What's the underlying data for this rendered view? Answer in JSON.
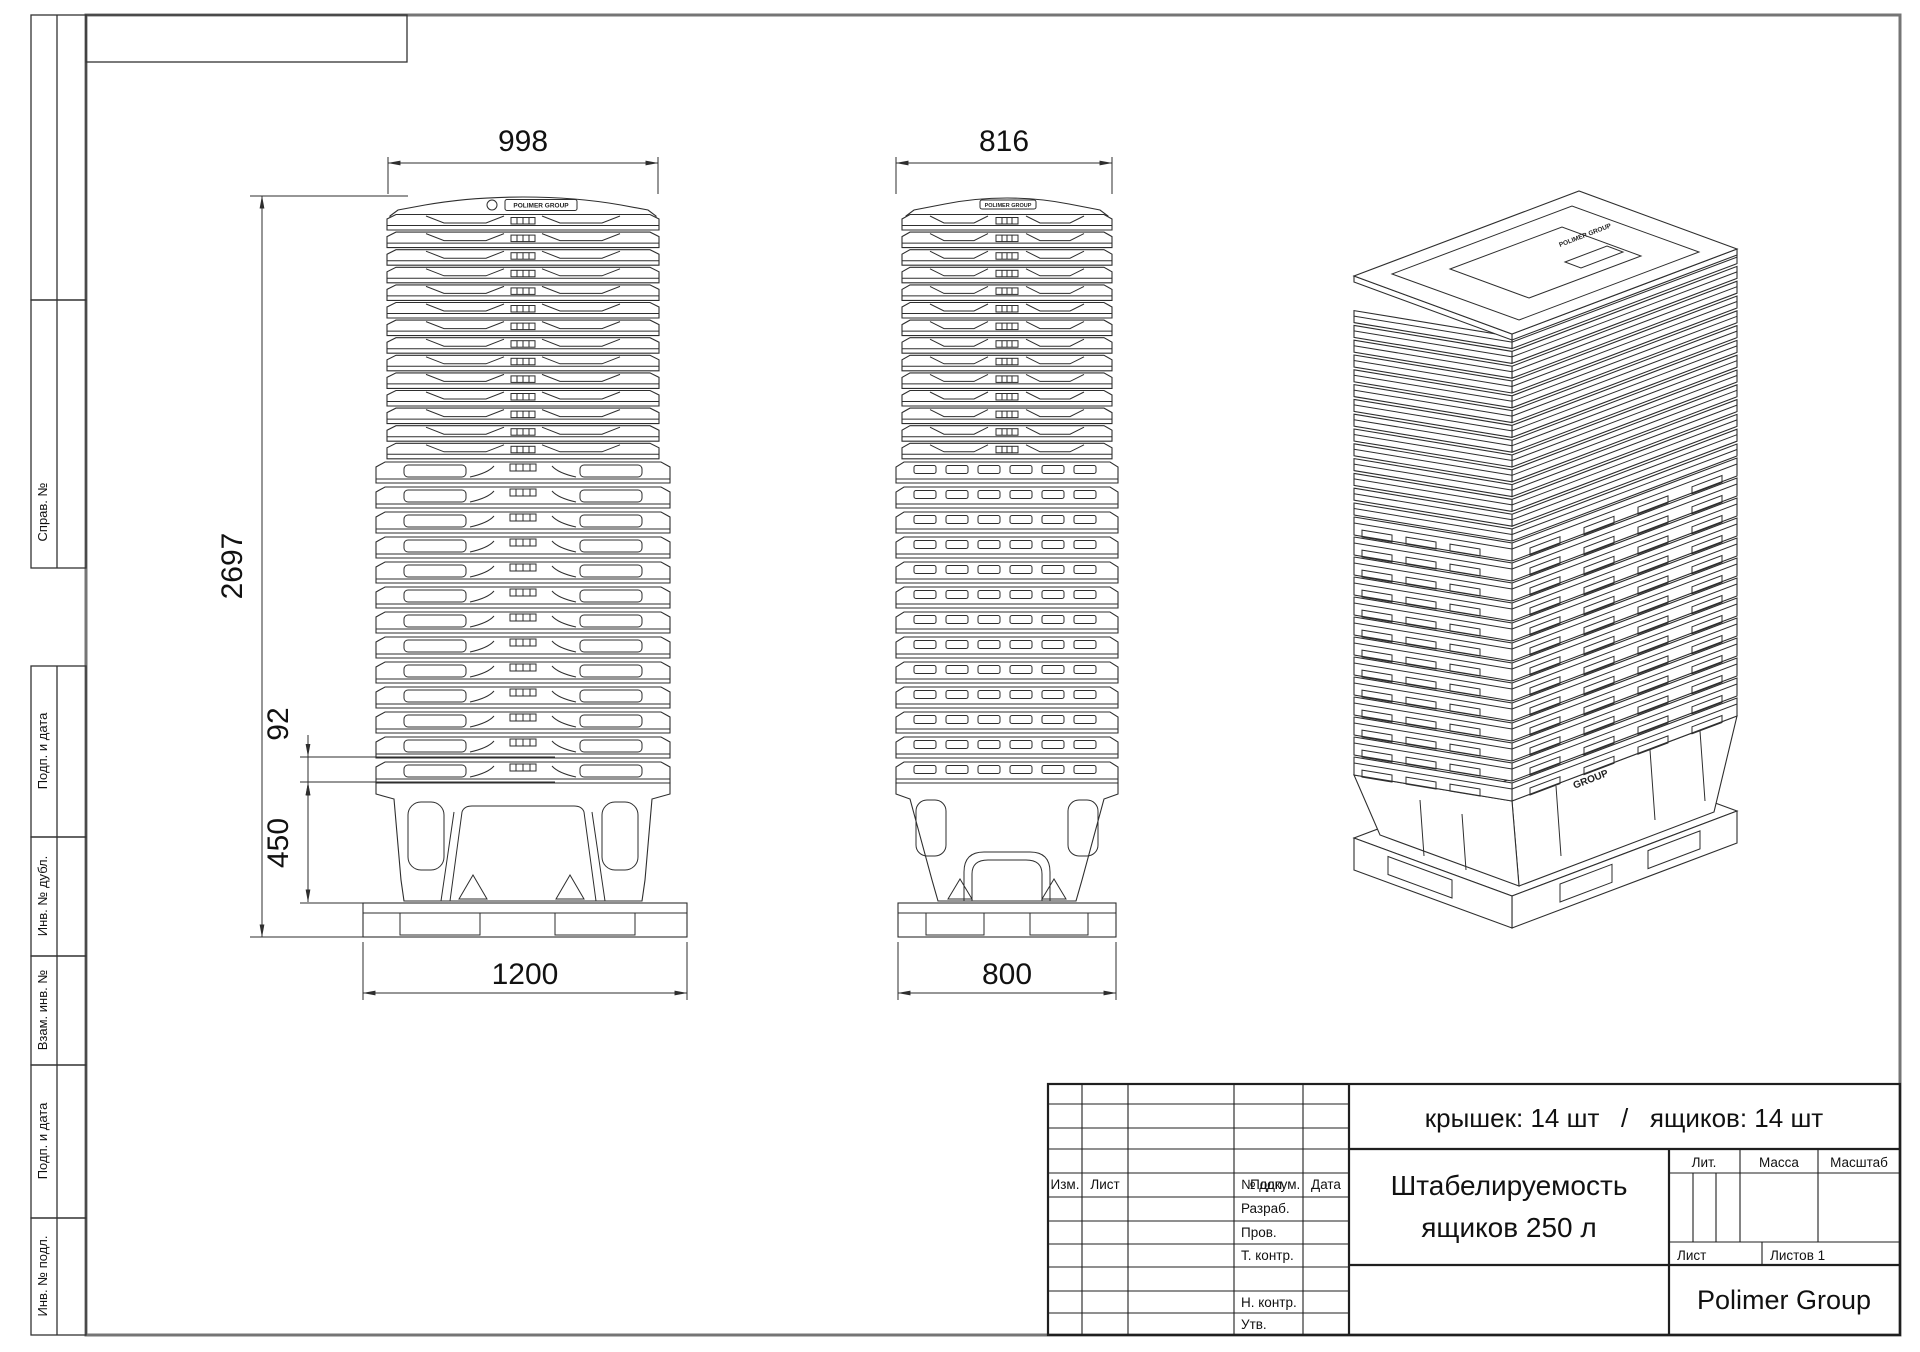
{
  "margin_labels": [
    "Справ. №",
    "Подп. и дата",
    "Инв. № дубл.",
    "Взам. инв. №",
    "Подп. и дата",
    "Инв. № подл."
  ],
  "dimensions": {
    "lid_stack_width": "998",
    "side_stack_width": "816",
    "total_height": "2697",
    "stack_pitch": "92",
    "box_height": "450",
    "pallet_length": "1200",
    "pallet_width": "800"
  },
  "stack": {
    "lids_count": 14,
    "boxes_count": 14
  },
  "brand": {
    "logo": "POLIMER GROUP",
    "logo_line1": "POLIMER",
    "logo_line2": "GROUP"
  },
  "title_block": {
    "summary": "крышек: 14 шт   /   ящиков: 14 шт",
    "title_line1": "Штабелируемость",
    "title_line2": "ящиков 250 л",
    "company": "Polimer Group",
    "labels": {
      "izm": "Изм.",
      "list": "Лист",
      "doc": "№ докум.",
      "podp": "Подп.",
      "date": "Дата",
      "razrab": "Разраб.",
      "prov": "Пров.",
      "tkontr": "Т. контр.",
      "nkontr": "Н. контр.",
      "utv": "Утв.",
      "lit": "Лит.",
      "massa": "Масса",
      "scale": "Масштаб",
      "sheet": "Лист",
      "sheets": "Листов 1"
    }
  }
}
